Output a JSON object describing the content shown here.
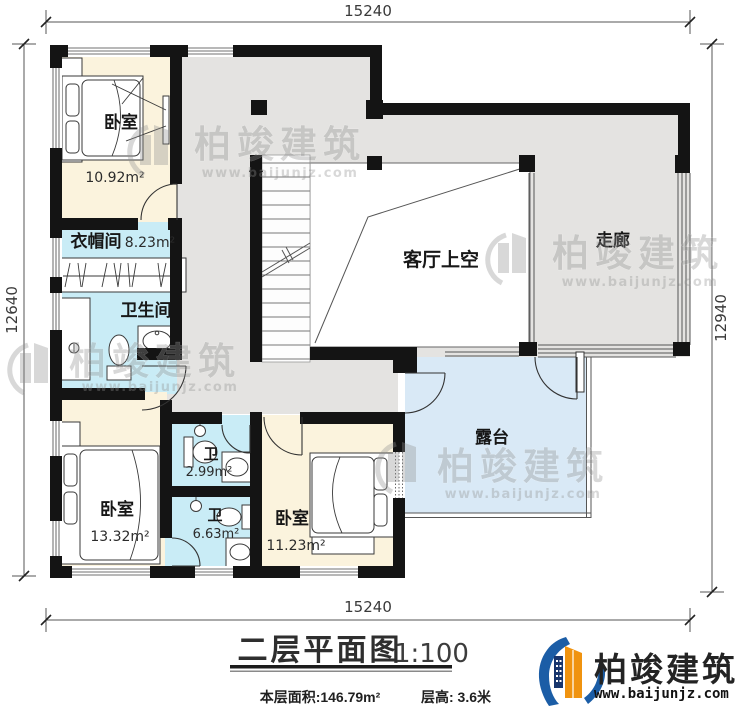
{
  "dimensions": {
    "top": "15240",
    "bottom": "15240",
    "left": "12640",
    "right": "12940"
  },
  "rooms": {
    "bedroom_nw": {
      "label": "卧室",
      "area": "10.92m²"
    },
    "cloakroom": {
      "label": "衣帽间",
      "area": "8.23m²"
    },
    "bathroom": {
      "label": "卫生间"
    },
    "living_void": {
      "label": "客厅上空"
    },
    "corridor": {
      "label": "走廊"
    },
    "bedroom_sw": {
      "label": "卧室",
      "area": "13.32m²"
    },
    "wc1": {
      "label": "卫",
      "area": "2.99m²"
    },
    "wc2": {
      "label": "卫",
      "area": "6.63m²"
    },
    "bedroom_s": {
      "label": "卧室",
      "area": "11.23m²"
    },
    "terrace": {
      "label": "露台"
    }
  },
  "titleblock": {
    "title": "二层平面图",
    "scale": "1:100",
    "floor_area": "本层面积:146.79m²",
    "floor_height": "层高: 3.6米"
  },
  "watermark": {
    "brand": "柏竣建筑",
    "url": "www.baijunjz.com"
  },
  "logo": {
    "brand": "柏竣建筑",
    "url": "www.baijunjz.com"
  },
  "colors": {
    "wall": "#141414",
    "floor_gray": "#e4e3e1",
    "bedroom_fill": "#fbf3dd",
    "bath_fill": "#c9ecf6",
    "terrace_fill": "#d9e9f6",
    "logo_blue": "#1b5da6",
    "logo_orange": "#f0930f",
    "logo_navy": "#17356d"
  }
}
